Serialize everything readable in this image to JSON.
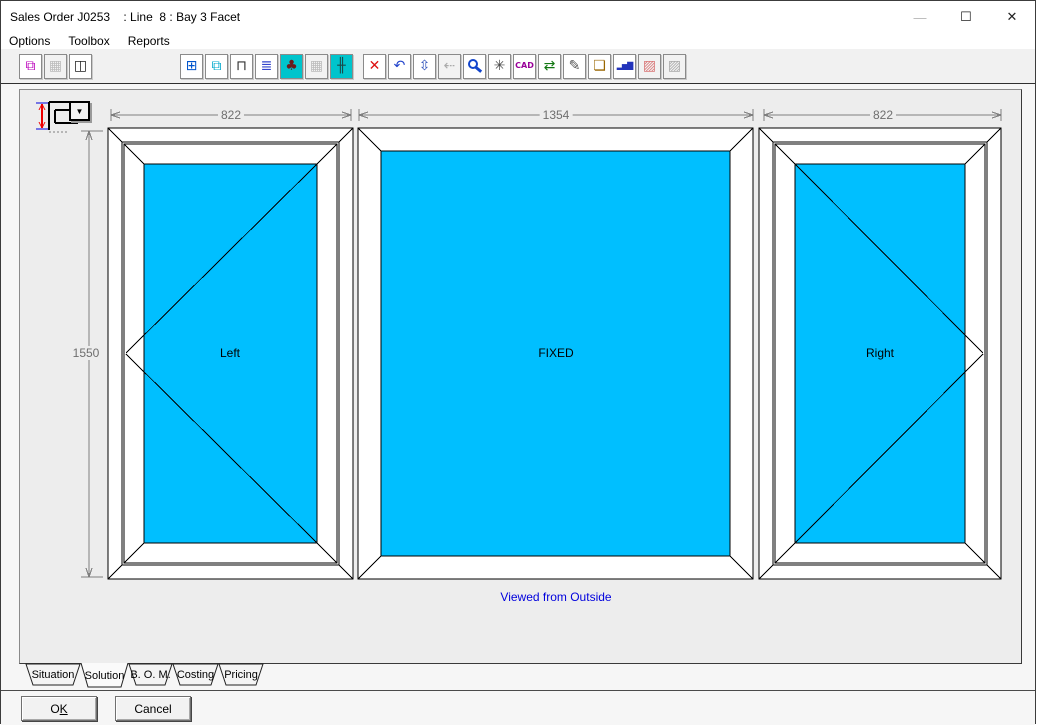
{
  "window": {
    "title": "Sales Order J0253    : Line  8 : Bay 3 Facet",
    "controls": {
      "minimize": "—",
      "maximize": "☐",
      "close": "✕"
    }
  },
  "menu": {
    "items": [
      {
        "label": "Options"
      },
      {
        "label": "Toolbox"
      },
      {
        "label": "Reports"
      }
    ]
  },
  "toolbar": {
    "buttons": [
      {
        "name": "profile-colors-icon",
        "glyph": "⧉",
        "color": "#bb00bb"
      },
      {
        "name": "grid-disabled-icon",
        "glyph": "▦",
        "color": "#bbbbbb",
        "disabled": true
      },
      {
        "name": "open-panel-icon",
        "glyph": "◫",
        "color": "#222222"
      },
      {
        "name": "frame-design-icon",
        "glyph": "⊞",
        "color": "#0055cc"
      },
      {
        "name": "glazing-icon",
        "glyph": "⧉",
        "color": "#00a8cc"
      },
      {
        "name": "hardware-icon",
        "glyph": "⊓",
        "color": "#333333"
      },
      {
        "name": "options-list-icon",
        "glyph": "≣",
        "color": "#3344cc"
      },
      {
        "name": "garden-view-icon",
        "glyph": "♣",
        "color": "#6b1a1a",
        "bg": "#00c4cc"
      },
      {
        "name": "pattern-disabled-icon",
        "glyph": "▦",
        "color": "#bbbbbb",
        "disabled": true
      },
      {
        "name": "transom-icon",
        "glyph": "╫",
        "color": "#1a4a4a",
        "bg": "#00c4cc"
      },
      {
        "name": "delete-icon",
        "glyph": "✕",
        "color": "#dd1111"
      },
      {
        "name": "undo-icon",
        "glyph": "↶",
        "color": "#2244cc"
      },
      {
        "name": "dimensions-icon",
        "glyph": "⇳",
        "color": "#3355bb"
      },
      {
        "name": "shift-disabled-icon",
        "glyph": "⇠",
        "color": "#aaaaaa",
        "disabled": true
      },
      {
        "name": "zoom-icon",
        "glyph": "",
        "color": "#1144cc"
      },
      {
        "name": "refresh-icon",
        "glyph": "✳",
        "color": "#444444"
      },
      {
        "name": "cad-icon",
        "glyph": "CAD",
        "color": "#990099"
      },
      {
        "name": "swap-icon",
        "glyph": "⇄",
        "color": "#117711"
      },
      {
        "name": "brush-icon",
        "glyph": "✎",
        "color": "#555555"
      },
      {
        "name": "export-icon",
        "glyph": "❏",
        "color": "#996600"
      },
      {
        "name": "chart-icon",
        "glyph": "▂▅▇",
        "color": "#2233bb"
      },
      {
        "name": "pricing-disabled-icon",
        "glyph": "▨",
        "color": "#d97777",
        "disabled": true
      },
      {
        "name": "notes-disabled-icon",
        "glyph": "▨",
        "color": "#aaaaaa",
        "disabled": true
      }
    ]
  },
  "designer": {
    "dims": {
      "top_left": "822",
      "top_middle": "1354",
      "top_right": "822",
      "side": "1550"
    },
    "panels": [
      {
        "label": "Left"
      },
      {
        "label": "FIXED"
      },
      {
        "label": "Right"
      }
    ],
    "caption": "Viewed from Outside",
    "colors": {
      "glass": "#00BFFF",
      "caption": "#0000DD",
      "dimension": "#7E7E7E"
    }
  },
  "tabs": {
    "items": [
      {
        "label": "Situation",
        "active": false
      },
      {
        "label": "Solution",
        "active": true
      },
      {
        "label": "B. O. M.",
        "active": false
      },
      {
        "label": "Costing",
        "active": false
      },
      {
        "label": "Pricing",
        "active": false
      }
    ]
  },
  "footer": {
    "ok_prefix": "O",
    "ok_key": "K",
    "cancel": "Cancel"
  }
}
